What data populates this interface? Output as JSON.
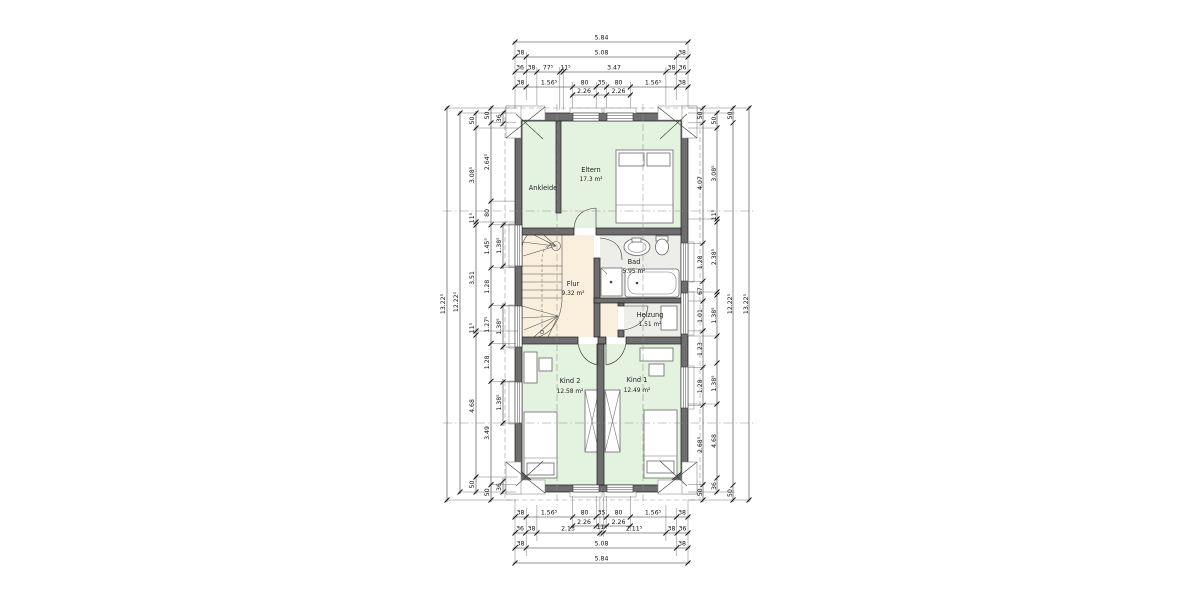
{
  "title": "Obergeschoss Grundriss",
  "colors": {
    "wall": "#6e6e6e",
    "room_green": "#e4f2e0",
    "hall_peach": "#faeedd",
    "bath_gray": "#ededea",
    "white": "#ffffff"
  },
  "rooms": {
    "eltern": {
      "name": "Eltern",
      "area": "17.3 m²"
    },
    "ankleide": {
      "name": "Ankleide"
    },
    "bad": {
      "name": "Bad",
      "area": "5.95 m²"
    },
    "flur": {
      "name": "Flur",
      "area": "9.32 m²"
    },
    "heizung": {
      "name": "Heizung",
      "area": "1.51 m²"
    },
    "kind2": {
      "name": "Kind 2",
      "area": "12.58 m²"
    },
    "kind1": {
      "name": "Kind 1",
      "area": "12.49 m²"
    }
  },
  "dims": {
    "top": {
      "row1": "5.84",
      "row2": [
        "38",
        "5.08",
        "38"
      ],
      "row3": [
        "36",
        "38",
        "77⁵",
        "11⁵",
        "3.47",
        "38",
        "36"
      ],
      "row4": [
        "38",
        "1.56⁵",
        "80",
        "35",
        "80",
        "1.56⁵",
        "38"
      ],
      "sub": [
        "2.26",
        "2.26"
      ]
    },
    "bottom": {
      "row1": [
        "38",
        "1.56⁵",
        "80",
        "35",
        "80",
        "1.56⁵",
        "38"
      ],
      "sub": [
        "2.26",
        "2.26"
      ],
      "row2": [
        "36",
        "38",
        "2.13",
        "11⁵",
        "2.11⁵",
        "38",
        "36"
      ],
      "row3": [
        "38",
        "5.08",
        "38"
      ],
      "row4": "5.84"
    },
    "left": {
      "total": "13.22⁵",
      "inner_total": "12.22⁵",
      "chain3": [
        "50",
        "3.08⁵",
        "11⁵",
        "3.51",
        "11⁵",
        "4.68",
        "50"
      ],
      "chain4": [
        "50",
        "2.64⁵",
        "80",
        "1.45⁵",
        "1.28",
        "1.27⁵",
        "1.28",
        "3.49",
        "50"
      ],
      "chain5": [
        "36",
        "1.38⁵",
        "1.38⁵",
        "1.38⁵",
        "36"
      ]
    },
    "right": {
      "chain1": [
        "50",
        "4.07",
        "1.28",
        "67",
        "1.01",
        "1.23",
        "1.28",
        "2.68⁵",
        "50"
      ],
      "chain2": [
        "50",
        "3.08⁵",
        "11⁵",
        "2.38⁵",
        "1.38⁵",
        "1.38⁵",
        "4.68",
        "36"
      ],
      "chain3": [
        "50",
        "12.22⁵",
        "50"
      ],
      "total": "13.22⁵"
    }
  }
}
